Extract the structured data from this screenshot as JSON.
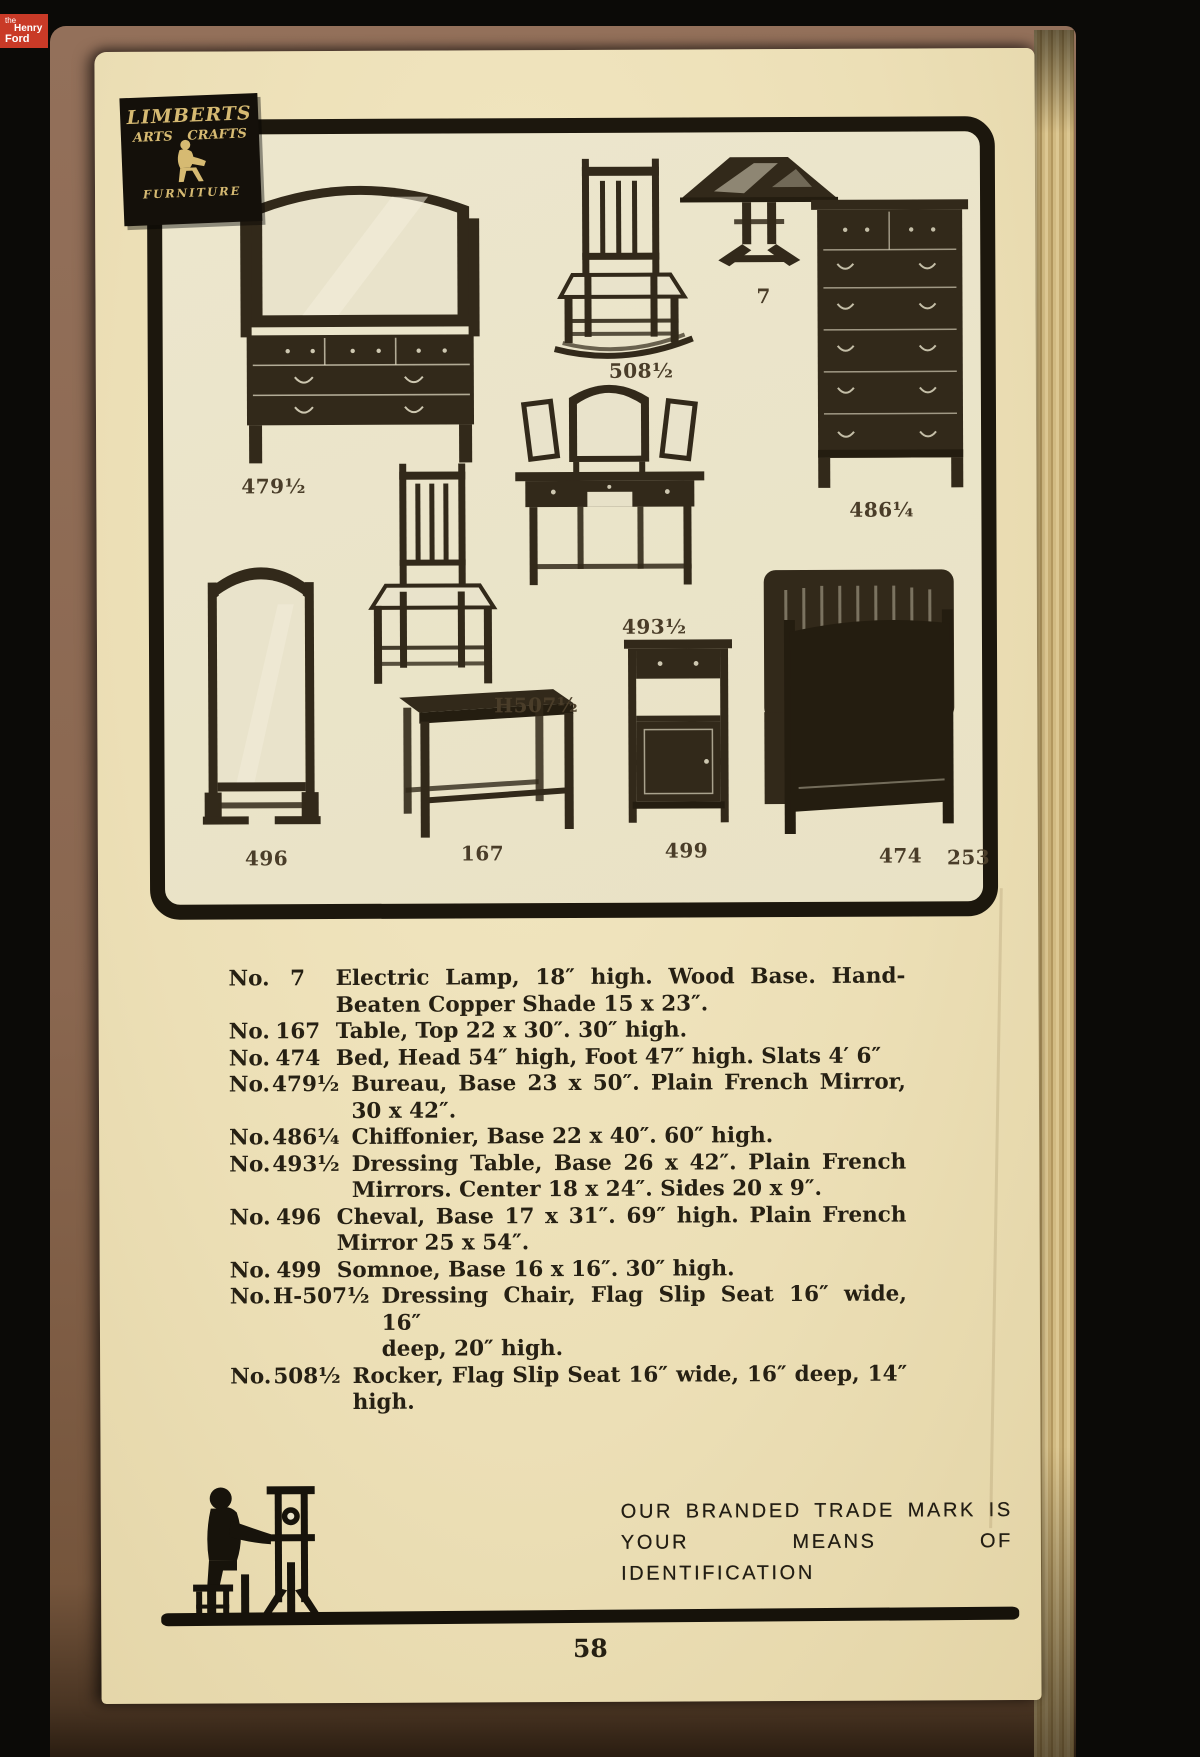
{
  "scan_overlay": {
    "brand": {
      "line1": "the",
      "line2": "Henry",
      "line3": "Ford"
    }
  },
  "page": {
    "plate": {
      "logo": {
        "line1": "LIMBERTS",
        "line2a": "ARTS",
        "line2b": "CRAFTS",
        "line3": "FURNITURE"
      },
      "labels": [
        {
          "id": "bureau",
          "text": "479½"
        },
        {
          "id": "rocker",
          "text": "508½"
        },
        {
          "id": "lamp",
          "text": "7"
        },
        {
          "id": "chiffonier",
          "text": "486¼"
        },
        {
          "id": "cheval",
          "text": "496"
        },
        {
          "id": "dressing-chair",
          "text": "H507½"
        },
        {
          "id": "dressing-table",
          "text": "493½"
        },
        {
          "id": "table",
          "text": "167"
        },
        {
          "id": "somnoe",
          "text": "499"
        },
        {
          "id": "bed",
          "text": "474"
        },
        {
          "id": "plate-number",
          "text": "253"
        }
      ]
    },
    "listings": [
      {
        "no": "No.",
        "num": "7",
        "lines": [
          "Electric Lamp, 18″ high.  Wood Base.  Hand-",
          "Beaten Copper Shade 15 x 23″."
        ]
      },
      {
        "no": "No.",
        "num": "167",
        "lines": [
          "Table, Top 22 x 30″.  30″ high."
        ]
      },
      {
        "no": "No.",
        "num": "474",
        "lines": [
          "Bed, Head 54″ high, Foot 47″ high.  Slats 4′ 6″"
        ]
      },
      {
        "no": "No.",
        "num": "479½",
        "lines": [
          "Bureau, Base 23 x 50″.  Plain French Mirror,",
          "30 x 42″."
        ]
      },
      {
        "no": "No.",
        "num": "486¼",
        "lines": [
          "Chiffonier, Base 22 x 40″.  60″ high."
        ]
      },
      {
        "no": "No.",
        "num": "493½",
        "lines": [
          "Dressing Table, Base 26 x 42″.  Plain French",
          "Mirrors.  Center 18 x 24″.  Sides 20 x 9″."
        ]
      },
      {
        "no": "No.",
        "num": "496",
        "lines": [
          "Cheval, Base 17 x 31″.  69″ high.  Plain French",
          "Mirror 25 x 54″."
        ]
      },
      {
        "no": "No.",
        "num": "499",
        "lines": [
          "Somnoe, Base 16 x 16″.  30″ high."
        ]
      },
      {
        "no": "No.",
        "num": "H-507½",
        "lines": [
          "Dressing Chair, Flag Slip Seat 16″ wide, 16″",
          "deep, 20″ high."
        ]
      },
      {
        "no": "No.",
        "num": "508½",
        "lines": [
          "Rocker, Flag Slip Seat 16″ wide, 16″ deep, 14″",
          "high."
        ]
      }
    ],
    "footer": {
      "tagline_line1": "OUR BRANDED TRADE MARK IS",
      "tagline_line2": "YOUR MEANS OF IDENTIFICATION",
      "page_number": "58"
    }
  }
}
